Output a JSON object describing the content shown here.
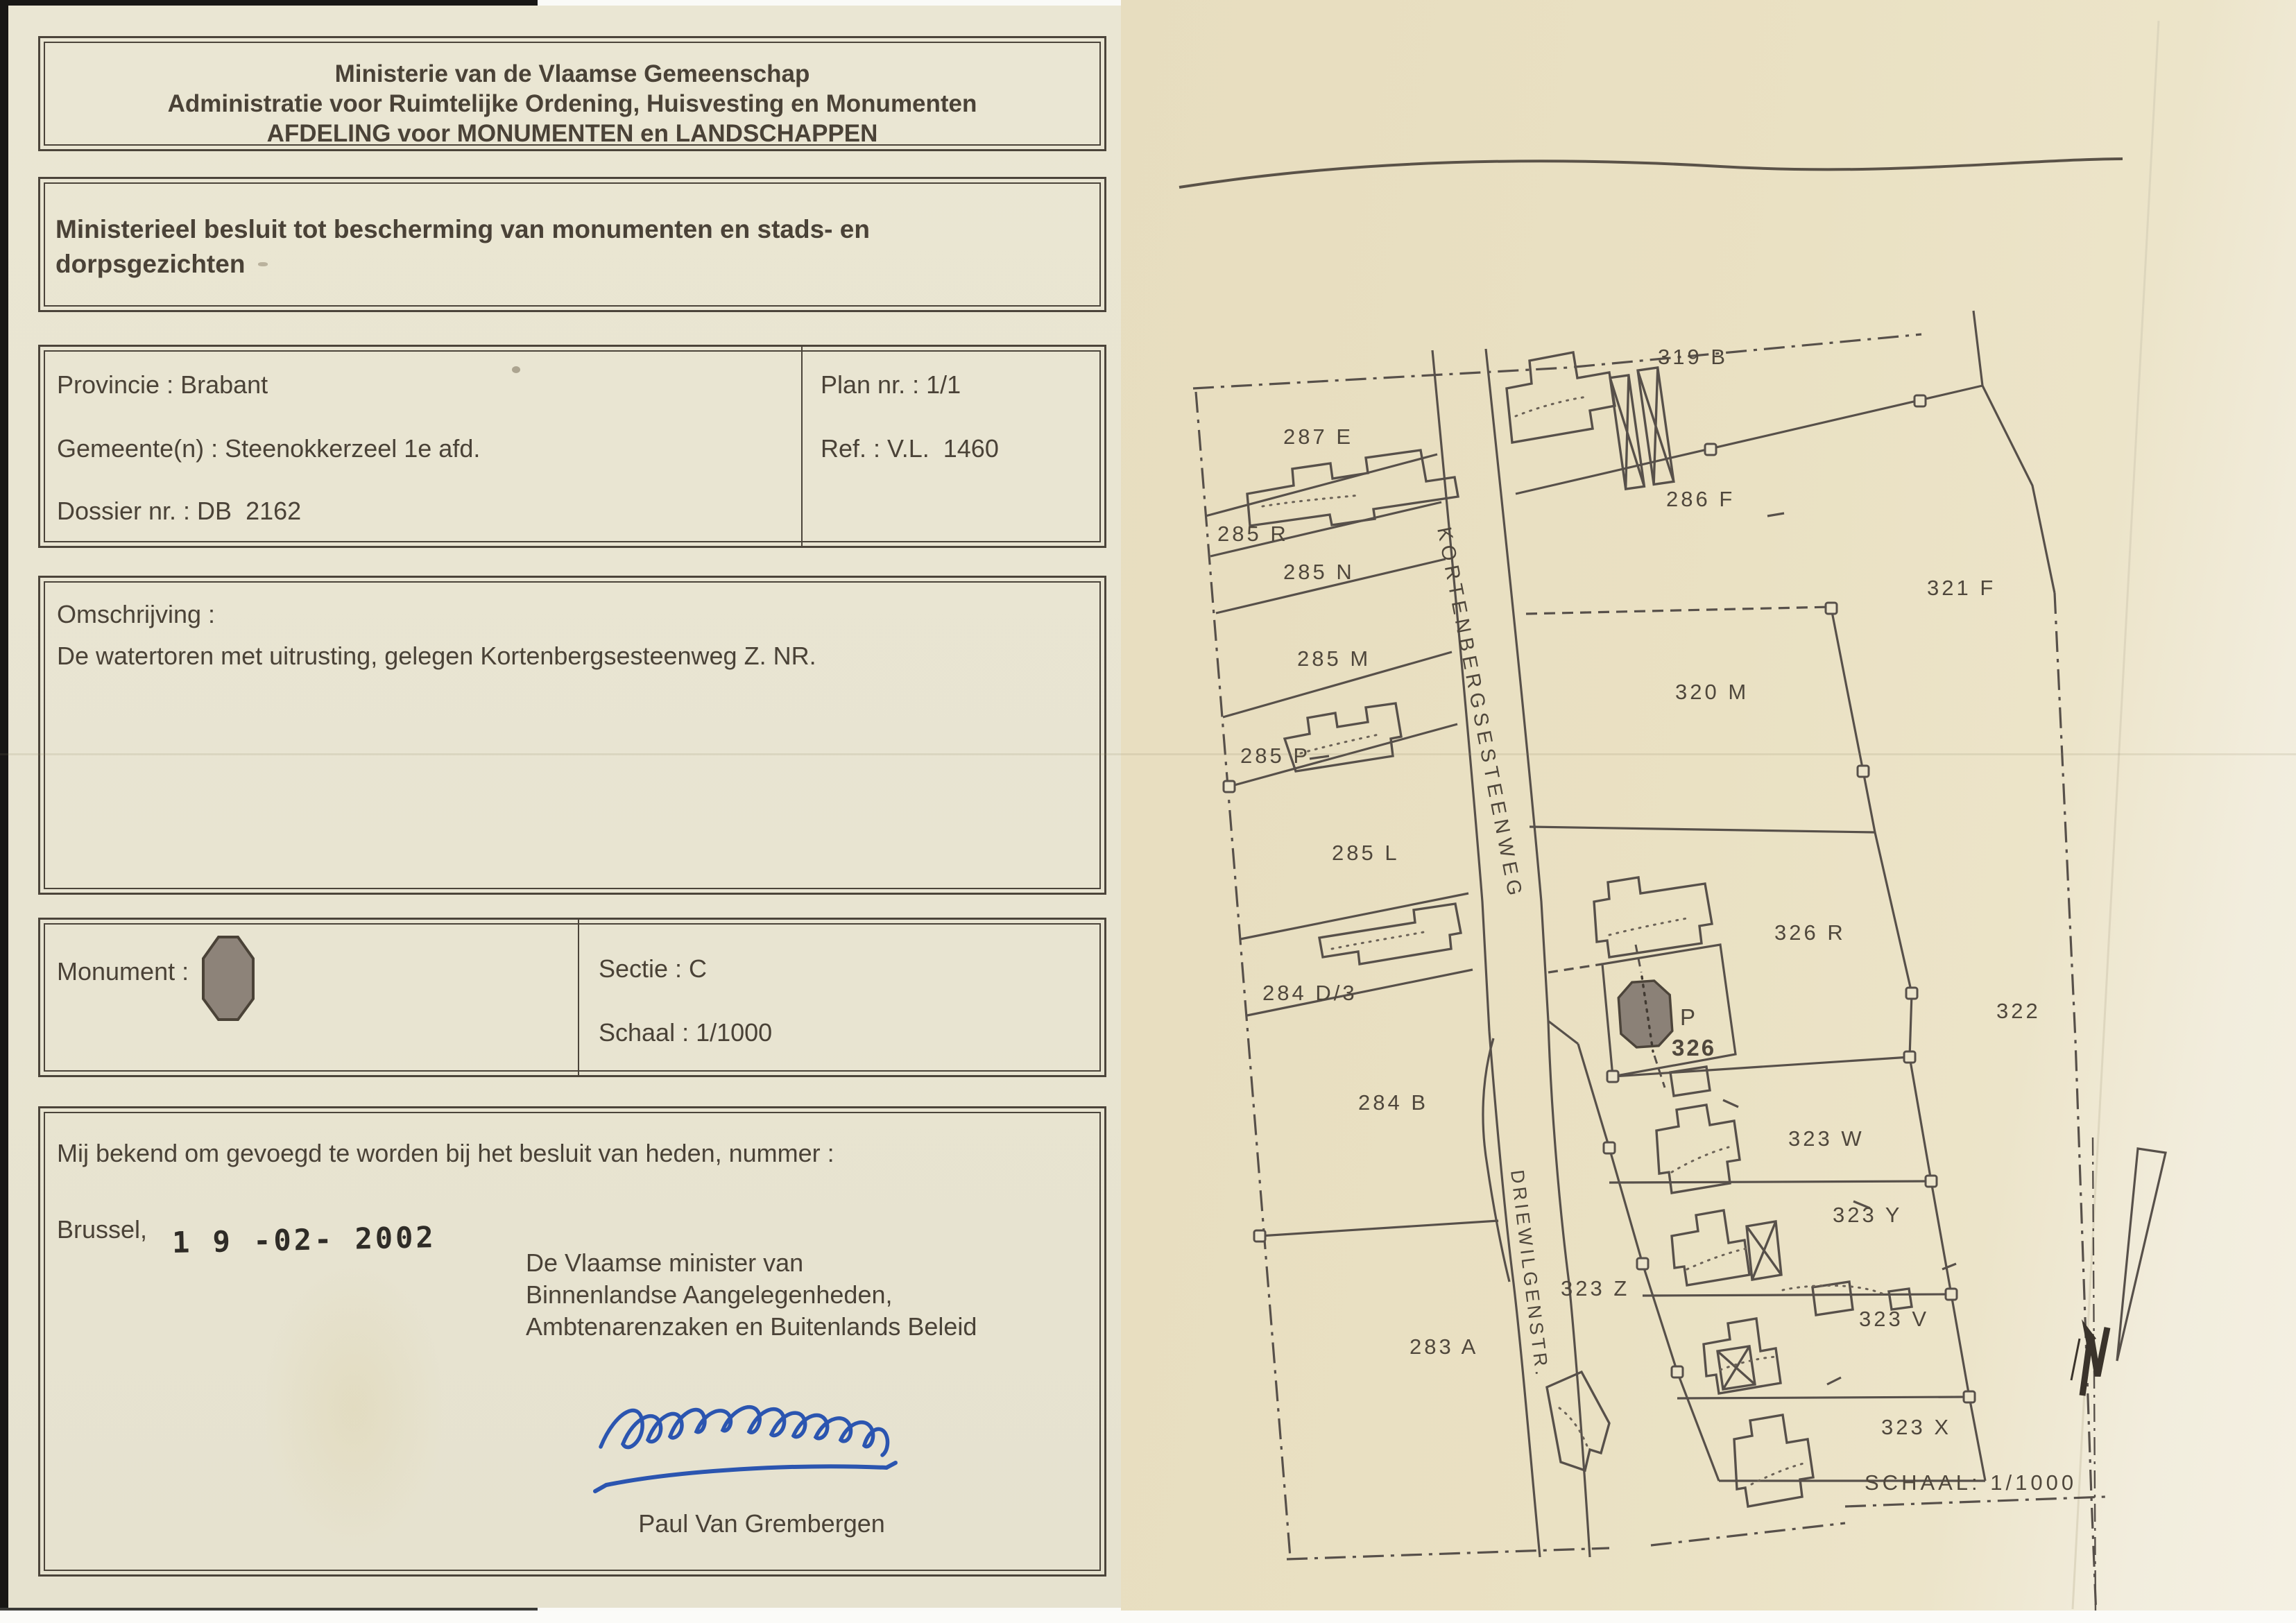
{
  "page": {
    "left_paper": "#e8e4d1",
    "right_paper": "#eae1c3",
    "ink": "#4a4237"
  },
  "form": {
    "header": {
      "line1": "Ministerie van de Vlaamse Gemeenschap",
      "line2": "Administratie voor Ruimtelijke Ordening, Huisvesting en Monumenten",
      "line3": "AFDELING voor MONUMENTEN en LANDSCHAPPEN"
    },
    "decree_title": "Ministerieel besluit tot bescherming van monumenten en stads- en dorpsgezichten",
    "info": {
      "provincie": "Provincie : Brabant",
      "gemeente": "Gemeente(n) : Steenokkerzeel 1e afd.",
      "dossier": "Dossier nr. : DB  2162",
      "plan_nr": "Plan nr. : 1/1",
      "ref": "Ref. : V.L.  1460"
    },
    "omschrijving": {
      "label": "Omschrijving :",
      "text": "De watertoren met uitrusting, gelegen Kortenbergsesteenweg Z. NR."
    },
    "monument": {
      "label": "Monument :",
      "sectie": "Sectie : C",
      "schaal": "Schaal : 1/1000",
      "symbol_fill": "#8d8379"
    },
    "closing": {
      "known_line": "Mij bekend om gevoegd te worden bij het besluit van heden, nummer :",
      "place": "Brussel,",
      "date_stamp": "1 9 -02- 2002",
      "minister_line1": "De Vlaamse minister van",
      "minister_line2": "Binnenlandse Aangelegenheden,",
      "minister_line3": "Ambtenarenzaken en Buitenlands Beleid",
      "signer": "Paul Van Grembergen",
      "signature_ink": "#2b55b0"
    }
  },
  "map": {
    "street_labels": {
      "kortenberg": "KORTENBERGSESTEENWEG",
      "driewilgen": "DRIEWILGENSTR."
    },
    "scale_label": "SCHAAL: 1/1000",
    "monument_marker": {
      "p": "P",
      "number": "326"
    },
    "parcel_labels": [
      "319 B",
      "287 E",
      "285 R",
      "285 N",
      "285 M",
      "285 P",
      "285 L",
      "284 D/3",
      "284 B",
      "283 A",
      "286 F",
      "321 F",
      "320 M",
      "326 R",
      "322",
      "323 W",
      "323 Y",
      "323 V",
      "323 X",
      "323 Z"
    ]
  }
}
